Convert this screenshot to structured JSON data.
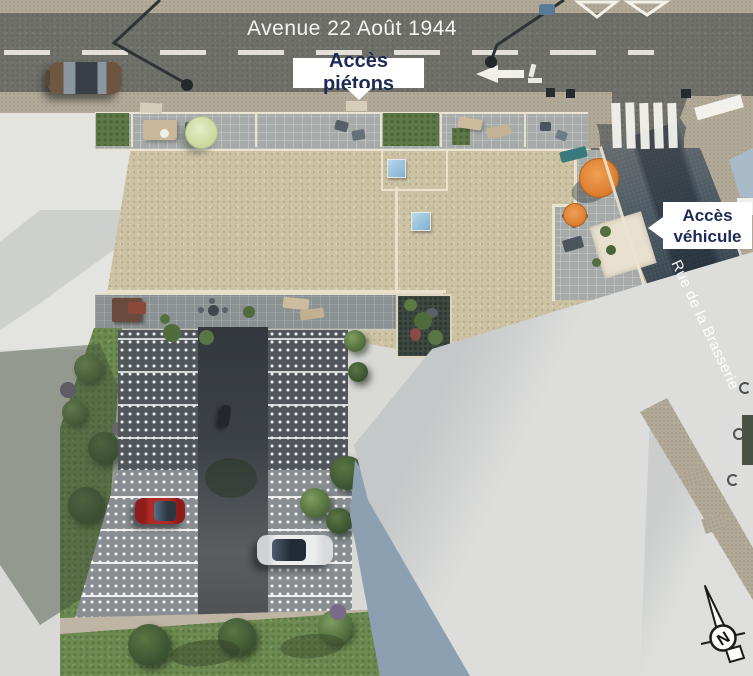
{
  "labels": {
    "avenue_name": "Avenue 22 Août 1944",
    "pedestrian_access": "Accès piétons",
    "vehicle_access": "Accès véhicule",
    "street_name": "Rue de la Brasserie",
    "compass_north": "N"
  },
  "colors": {
    "label_text_navy": "#1e2a56",
    "label_background": "#ffffff",
    "roof_beige": "#cbc2a4",
    "street_dark": "#2c3845",
    "avenue_asphalt": "#6f706a",
    "umbrella_orange": "#e2863a",
    "umbrella_pale_green": "#dbe6ba",
    "parked_car_red": "#a8201e",
    "parked_car_white": "#e9eaea",
    "lawn_green": "#6d8a52",
    "skylight_blue": "#8fc0dc"
  }
}
